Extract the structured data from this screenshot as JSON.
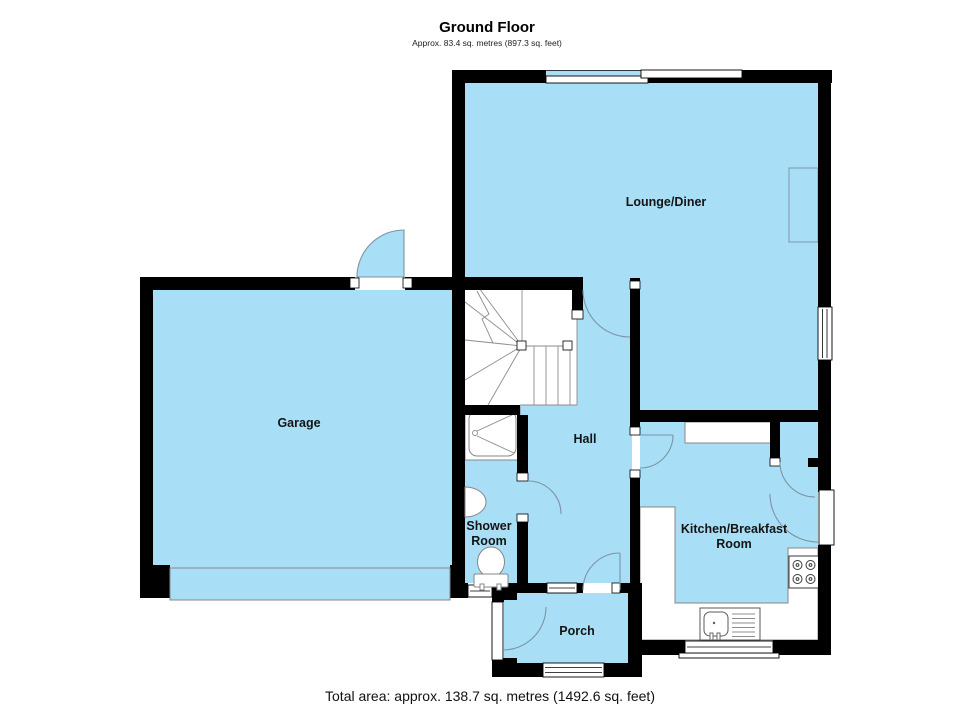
{
  "title": "Ground Floor",
  "subtitle": "Approx. 83.4 sq. metres (897.3 sq. feet)",
  "footer": "Total area: approx. 138.7 sq. metres (1492.6 sq. feet)",
  "rooms": {
    "lounge": {
      "label": "Lounge/Diner"
    },
    "garage": {
      "label": "Garage"
    },
    "hall": {
      "label": "Hall"
    },
    "shower": {
      "line1": "Shower",
      "line2": "Room"
    },
    "kitchen": {
      "line1": "Kitchen/Breakfast",
      "line2": "Room"
    },
    "porch": {
      "label": "Porch"
    }
  },
  "colors": {
    "floor": "#a8dff7",
    "wall": "#000000",
    "outline": "#8c8c8c",
    "door_arc": "#7d93a3"
  }
}
